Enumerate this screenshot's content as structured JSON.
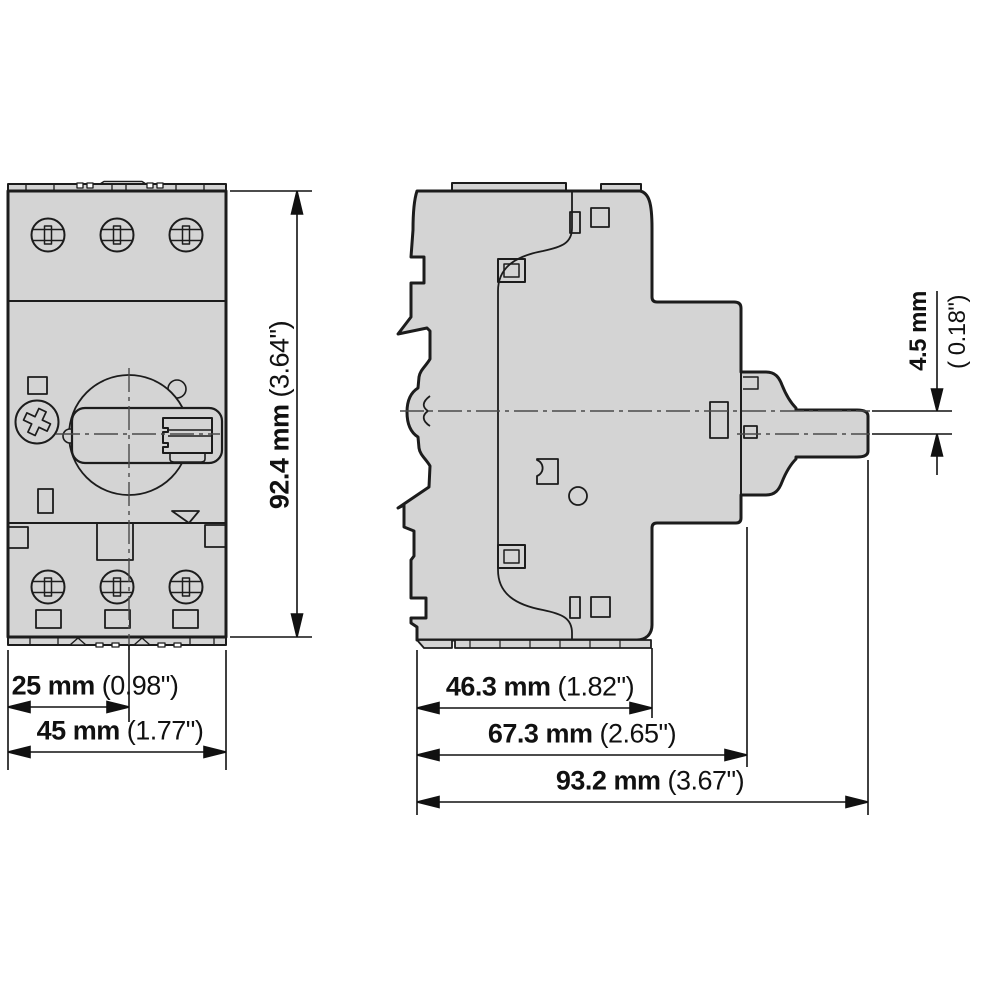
{
  "drawing": {
    "title": "motor-protective-circuit-breaker-dimension-drawing",
    "colors": {
      "background": "#ffffff",
      "body_fill": "#d4d4d4",
      "outline": "#1c1c1c",
      "dimension": "#111111",
      "centerline": "#4a4a4a"
    },
    "views": {
      "front_label": "front-view",
      "side_label": "side-view"
    },
    "dimensions": {
      "front_height": {
        "mm": "92.4 mm",
        "inch": "(3.64\")"
      },
      "front_width_to_center": {
        "mm": "25 mm",
        "inch": "(0.98\")"
      },
      "front_width": {
        "mm": "45 mm",
        "inch": "(1.77\")"
      },
      "side_depth_body": {
        "mm": "46.3 mm",
        "inch": "(1.82\")"
      },
      "side_depth_with_pad": {
        "mm": "67.3 mm",
        "inch": "(2.65\")"
      },
      "side_depth_total": {
        "mm": "93.2 mm",
        "inch": "(3.67\")"
      },
      "handle_axis_offset": {
        "mm": "4.5 mm",
        "inch": "( 0.18\")"
      }
    }
  }
}
